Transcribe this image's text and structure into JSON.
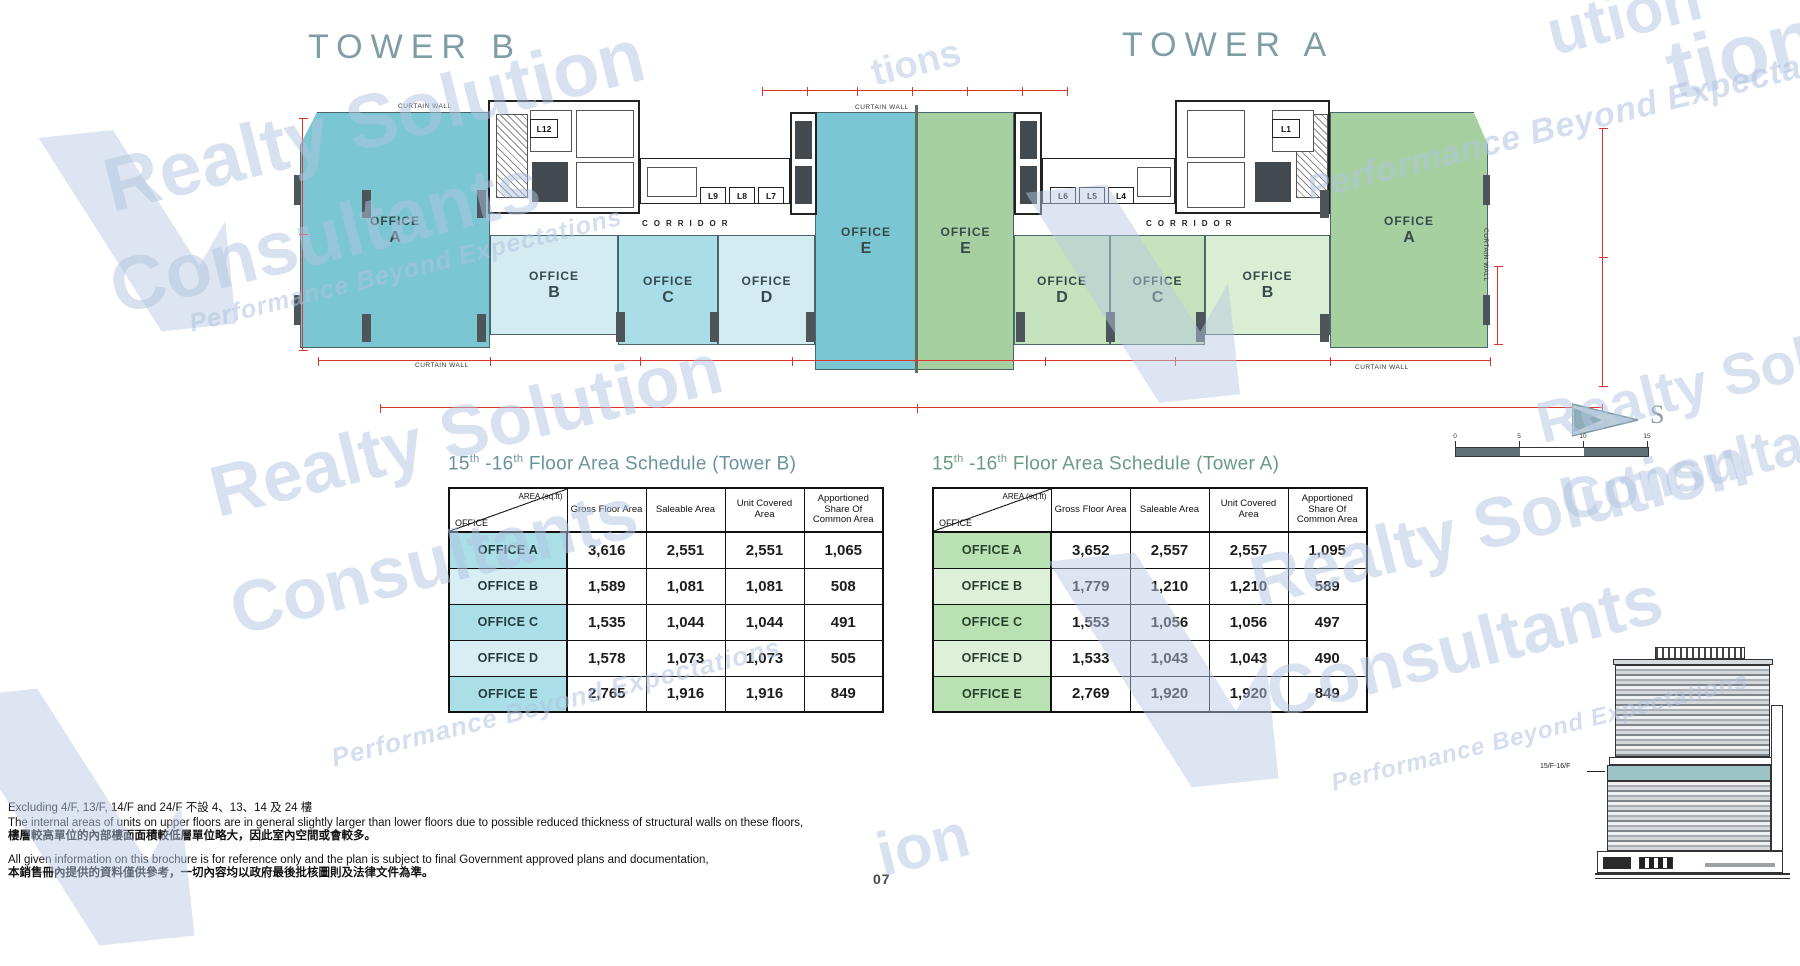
{
  "header": {
    "tower_b": "TOWER B",
    "tower_a": "TOWER A"
  },
  "plan": {
    "office_word": "OFFICE",
    "letters_b": [
      "A",
      "B",
      "C",
      "D",
      "E"
    ],
    "letters_a": [
      "E",
      "D",
      "C",
      "B",
      "A"
    ],
    "corridor": "CORRIDOR",
    "curtain_wall": "CURTAIN WALL",
    "lifts_b": [
      "L12",
      "L9",
      "L8",
      "L7"
    ],
    "lifts_a": [
      "L6",
      "L5",
      "L4",
      "L1"
    ],
    "compass": "S",
    "scale_ticks": [
      "0",
      "5",
      "10",
      "15"
    ]
  },
  "schedules": [
    {
      "t1": "15",
      "sup1": "th",
      "t2": " -16",
      "sup2": "th",
      "t3": " Floor Area Schedule (Tower  B)",
      "corner_top": "AREA (sq.ft)",
      "corner_bottom": "OFFICE",
      "columns": [
        "Gross Floor Area",
        "Saleable Area",
        "Unit Covered Area",
        "Apportioned Share Of Common Area"
      ],
      "rows": [
        {
          "label": "OFFICE A",
          "values": [
            "3,616",
            "2,551",
            "2,551",
            "1,065"
          ]
        },
        {
          "label": "OFFICE B",
          "values": [
            "1,589",
            "1,081",
            "1,081",
            "508"
          ]
        },
        {
          "label": "OFFICE C",
          "values": [
            "1,535",
            "1,044",
            "1,044",
            "491"
          ]
        },
        {
          "label": "OFFICE D",
          "values": [
            "1,578",
            "1,073",
            "1,073",
            "505"
          ]
        },
        {
          "label": "OFFICE E",
          "values": [
            "2,765",
            "1,916",
            "1,916",
            "849"
          ]
        }
      ]
    },
    {
      "t1": "15",
      "sup1": "th",
      "t2": " -16",
      "sup2": "th",
      "t3": " Floor Area Schedule (Tower  A)",
      "corner_top": "AREA (sq.ft)",
      "corner_bottom": "OFFICE",
      "columns": [
        "Gross Floor Area",
        "Saleable Area",
        "Unit Covered Area",
        "Apportioned Share Of Common Area"
      ],
      "rows": [
        {
          "label": "OFFICE A",
          "values": [
            "3,652",
            "2,557",
            "2,557",
            "1,095"
          ]
        },
        {
          "label": "OFFICE B",
          "values": [
            "1,779",
            "1,210",
            "1,210",
            "589"
          ]
        },
        {
          "label": "OFFICE C",
          "values": [
            "1,553",
            "1,056",
            "1,056",
            "497"
          ]
        },
        {
          "label": "OFFICE D",
          "values": [
            "1,533",
            "1,043",
            "1,043",
            "490"
          ]
        },
        {
          "label": "OFFICE E",
          "values": [
            "2,769",
            "1,920",
            "1,920",
            "849"
          ]
        }
      ]
    }
  ],
  "elevation": {
    "label": "15/F-16/F"
  },
  "footer": {
    "page_number": "07",
    "notes": [
      "Excluding  4/F, 13/F, 14/F and 24/F    不設 4、13、14 及 24 樓",
      "The internal areas of units on upper floors are in general slightly larger than lower floors due to possible reduced thickness of structural walls on these floors,",
      "樓層較高單位的內部樓面面積較低層單位略大，因此室內空間或會較多。",
      "All given information on this brochure is for reference only and the plan is subject to final Government approved plans and documentation,",
      "本銷售冊內提供的資料僅供參考，一切內容均以政府最後批核圖則及法律文件為準。"
    ]
  },
  "watermark": {
    "line1": "Realty Solution",
    "line2": "Consultants",
    "tagline": "Performance Beyond Expectations",
    "fragments": [
      "ution",
      "tion",
      "tions",
      "ion"
    ]
  },
  "colors": {
    "teal_dark": "#7ac6d2",
    "teal_mid": "#a9dde7",
    "teal_pale": "#d2ecf1",
    "green_mid": "#a6d0a0",
    "green_light": "#c4e3bd",
    "green_pale": "#daeed4",
    "dim_red": "#d9372e",
    "watermark_blue": "#c2d1e8",
    "title_grey_teal": "#7f9da5",
    "sched_title_b": "#68949c",
    "sched_title_a": "#6a9b80"
  }
}
